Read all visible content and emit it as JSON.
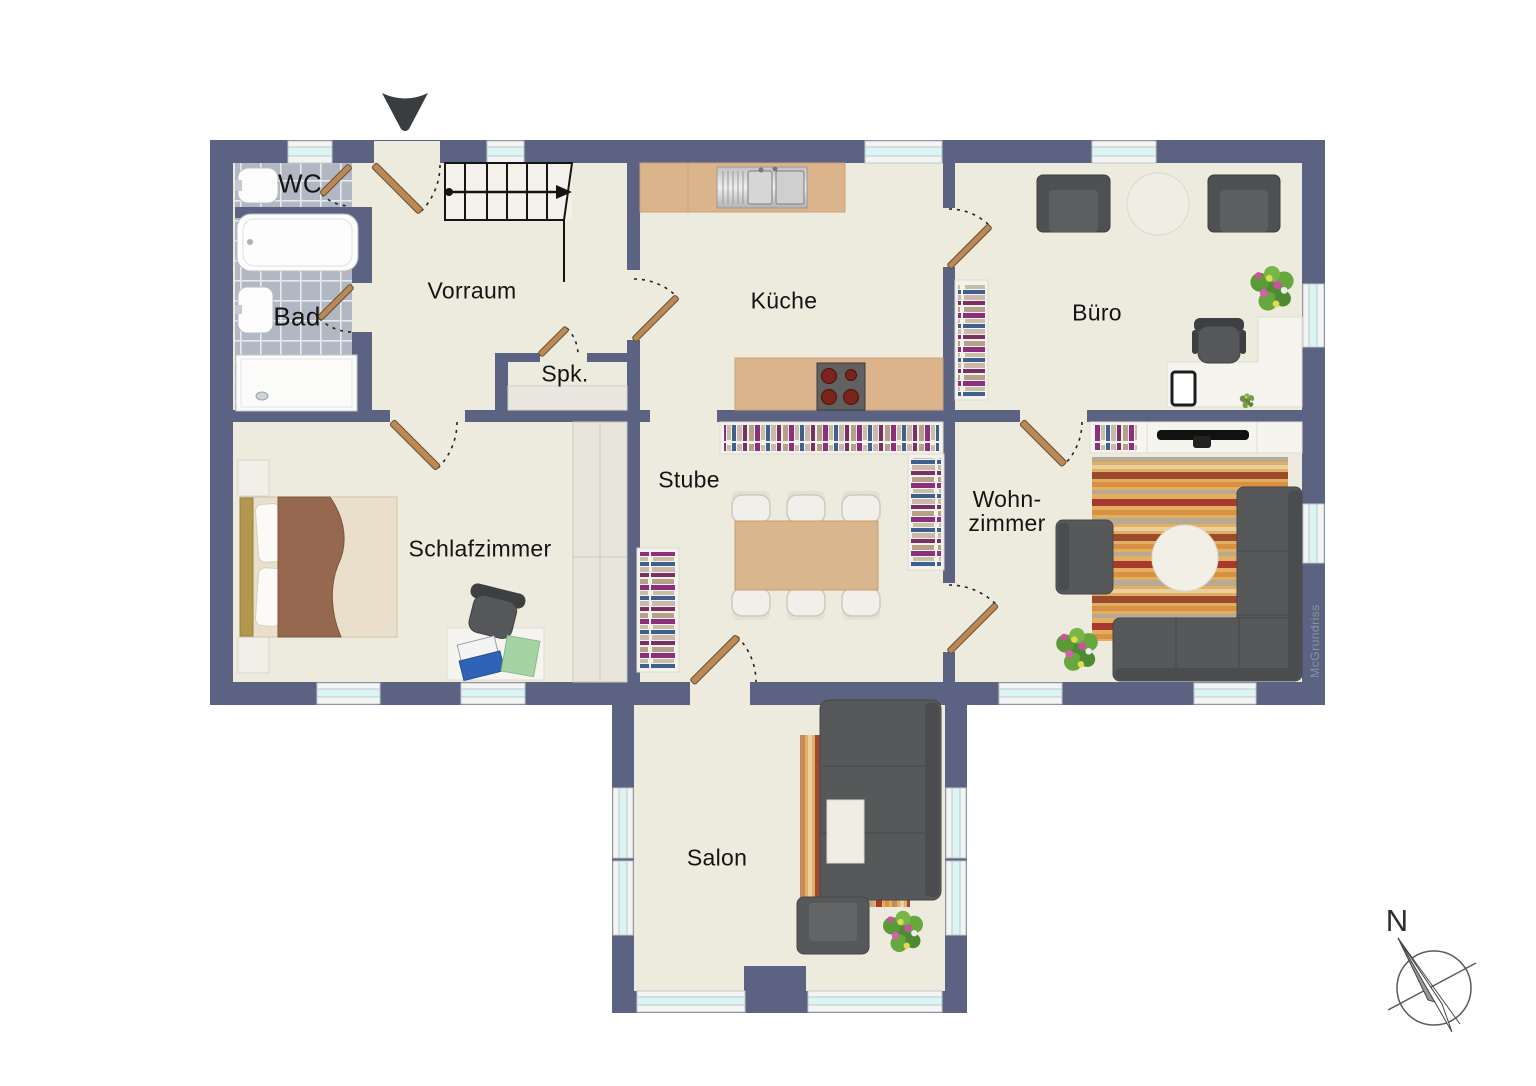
{
  "rooms": {
    "wc": {
      "label": "WC"
    },
    "bad": {
      "label": "Bad"
    },
    "vorraum": {
      "label": "Vorraum"
    },
    "spk": {
      "label": "Spk."
    },
    "kueche": {
      "label": "Küche"
    },
    "buero": {
      "label": "Büro"
    },
    "schlafzimmer": {
      "label": "Schlafzimmer"
    },
    "stube": {
      "label": "Stube"
    },
    "wohnzimmer": {
      "label_line1": "Wohn-",
      "label_line2": "zimmer"
    },
    "salon": {
      "label": "Salon"
    }
  },
  "compass": {
    "north_label": "N"
  },
  "watermark": "McGrundriss",
  "icons": {
    "entrance_marker": "down-triangle",
    "compass": "north-needle"
  },
  "colors": {
    "wall": "#5b6282",
    "floor": "#edeade",
    "tile": "#b2b8c3",
    "window_glass": "#daf5f4",
    "door_leaf": "#b98a58",
    "furniture_dark": "#56575a",
    "counter_wood": "#dcb48c",
    "rug_base": "#e2ae62",
    "bed_blanket": "#96684f"
  }
}
